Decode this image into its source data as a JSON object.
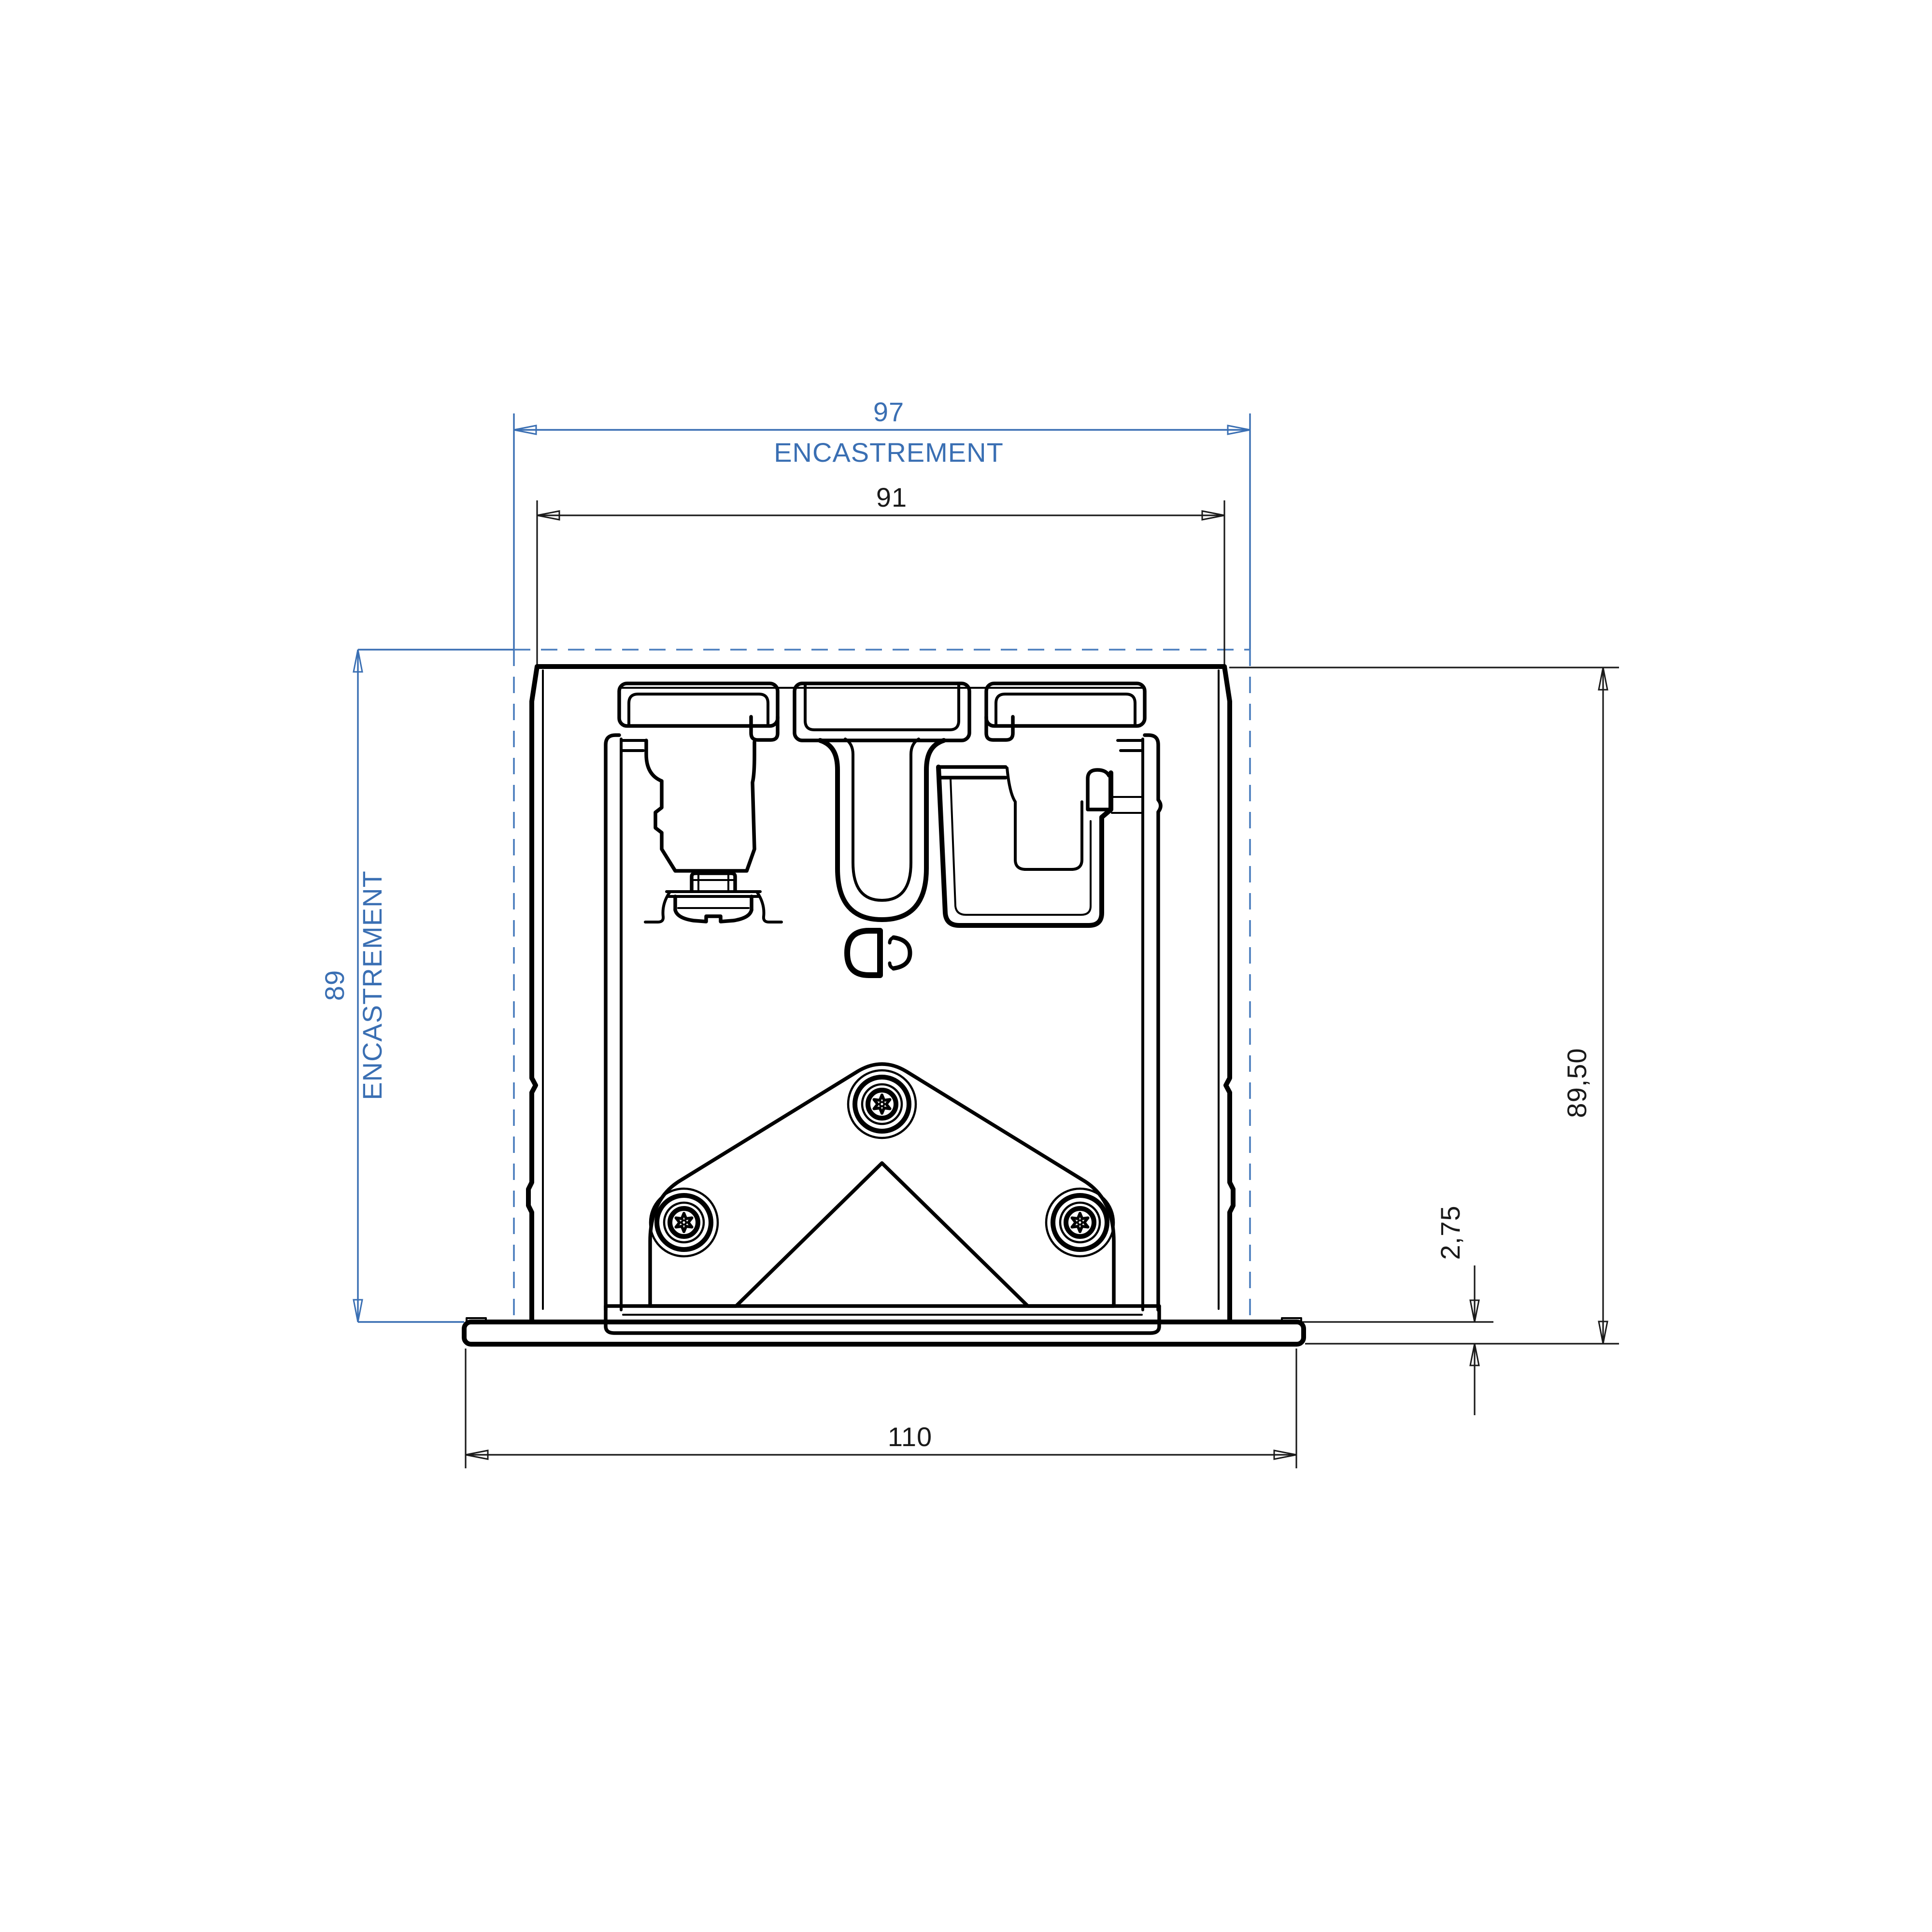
{
  "dimensions": {
    "recess_width": {
      "value": "97",
      "label": "ENCASTREMENT"
    },
    "body_width": {
      "value": "91"
    },
    "recess_depth": {
      "value": "89",
      "label": "ENCASTREMENT"
    },
    "overall_height": {
      "value": "89,50"
    },
    "flange_thickness": {
      "value": "2,75"
    },
    "flange_width": {
      "value": "110"
    }
  },
  "colors": {
    "dimension_accent_blue": "#3a6fb3",
    "recess_dashed_blue": "#4a7dbd",
    "drawing_line_black": "#000000",
    "background": "#ffffff"
  }
}
